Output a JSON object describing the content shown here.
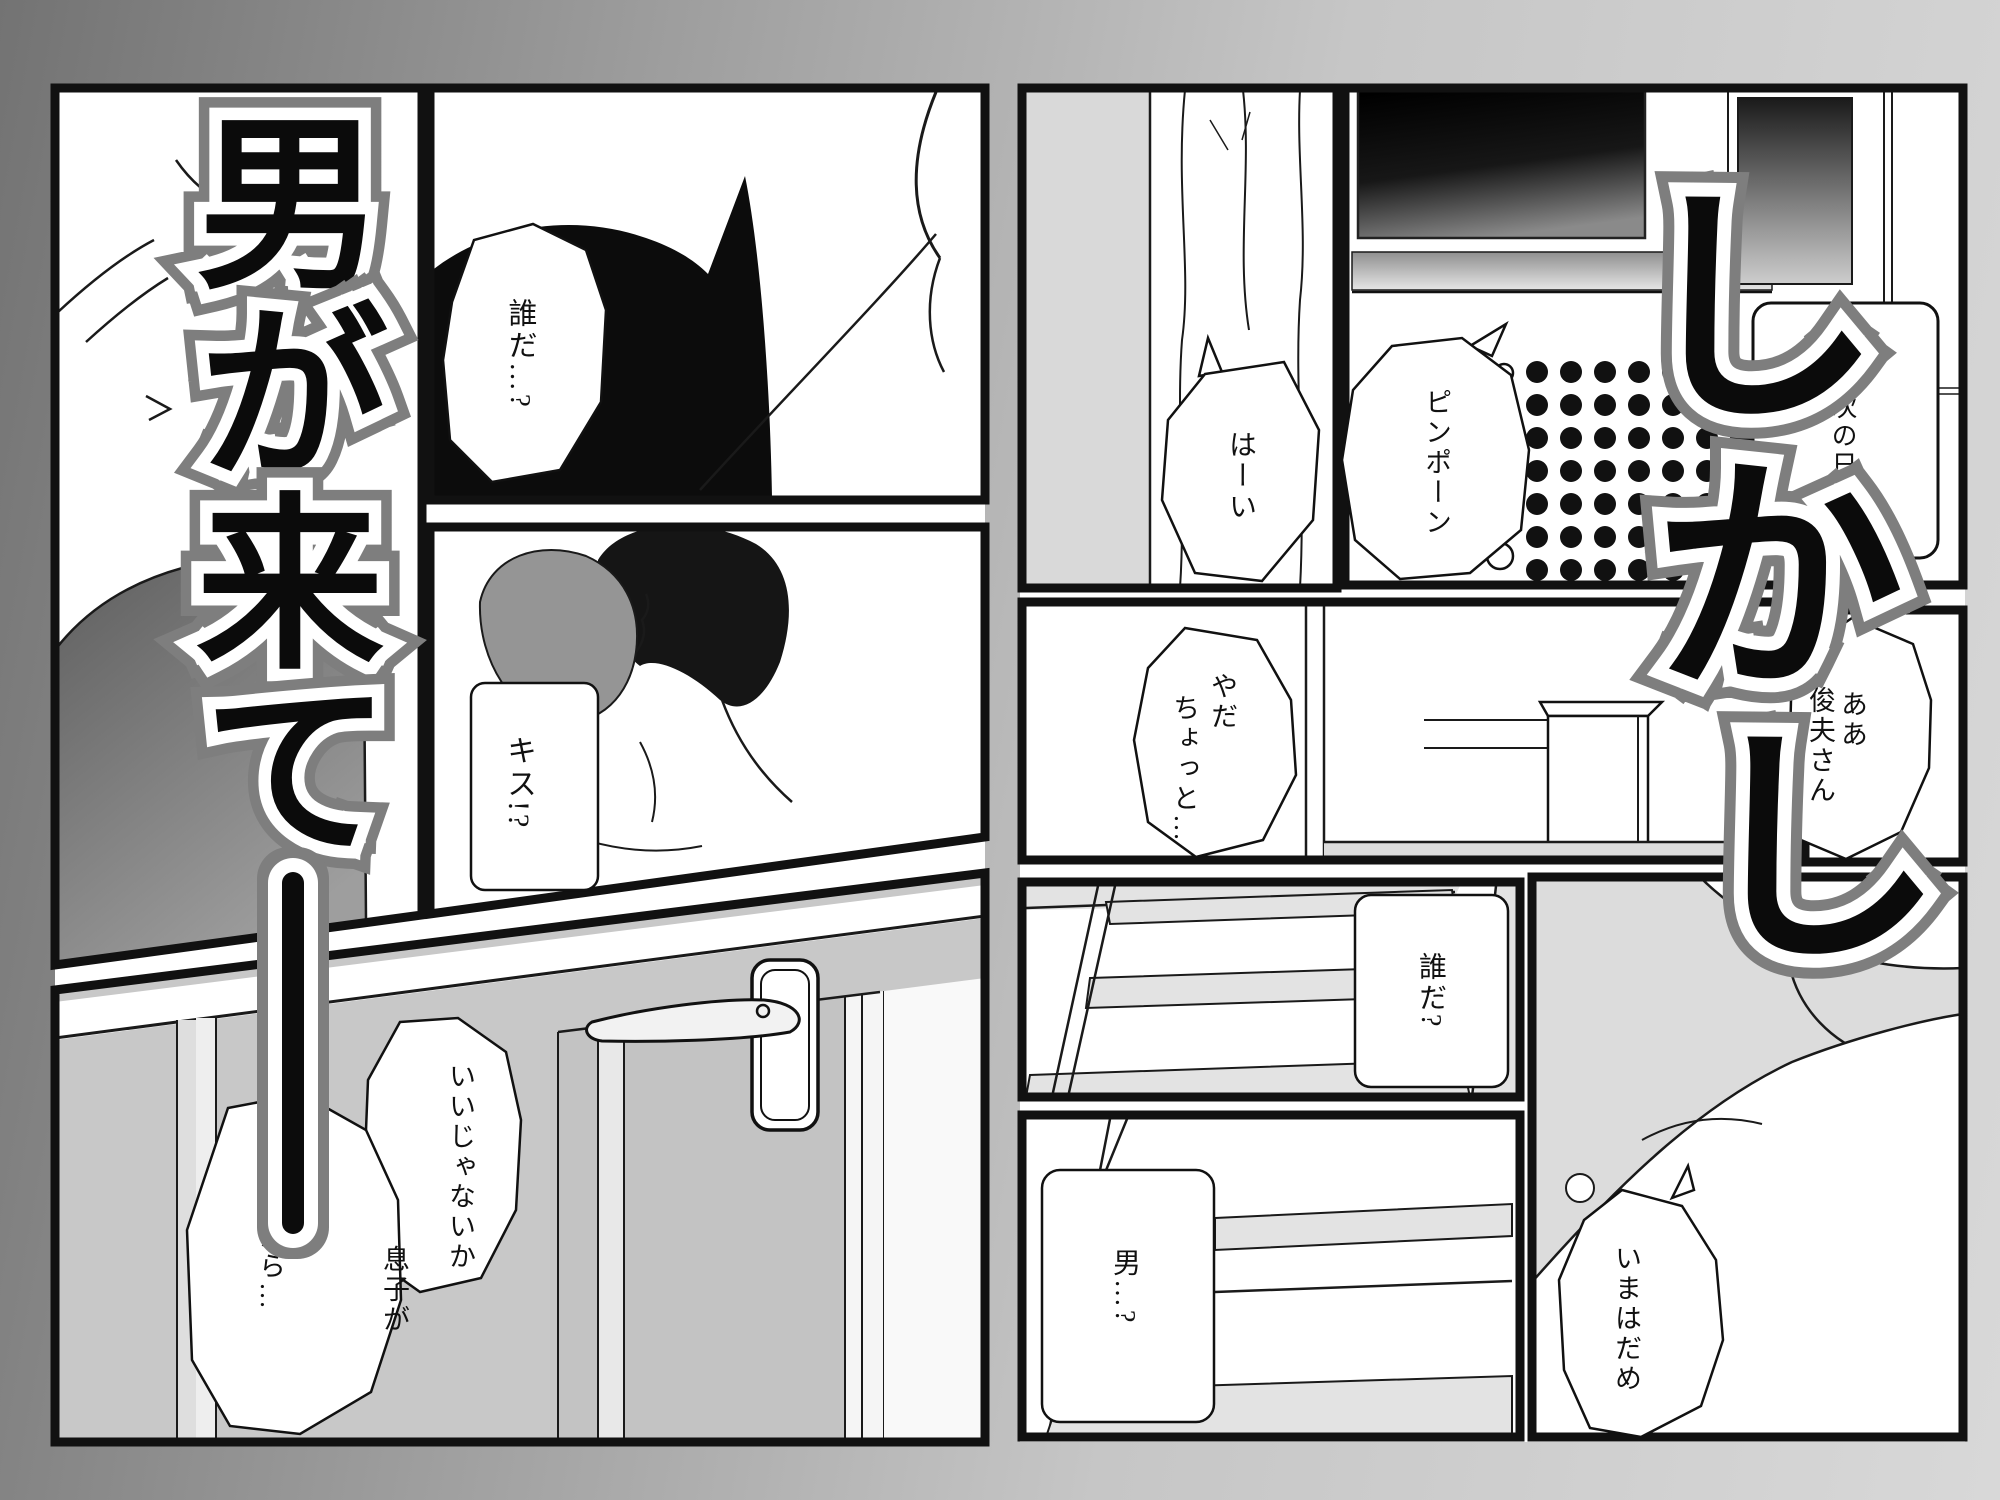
{
  "titles": {
    "left": {
      "text": "男が来て――",
      "chars": [
        "男",
        "が",
        "来",
        "て"
      ]
    },
    "right": {
      "text": "しかし",
      "chars": [
        "し",
        "か",
        "し"
      ]
    }
  },
  "left_page": {
    "panel_top_black": {
      "bubble": "誰だ…?"
    },
    "panel_kiss": {
      "caption": "キス!?"
    },
    "panel_door": {
      "bubble_approval": "いいじゃないか",
      "bubble_son_col_right": "息子が",
      "bubble_son_col_left": "いるから…"
    }
  },
  "right_page": {
    "panel_entry": {
      "bubble": "はーい"
    },
    "panel_intercom": {
      "sfx_bubble": "ピンポーン",
      "caption": "次の日"
    },
    "panel_hall": {
      "bubble_col_right": "やだ",
      "bubble_col_left": "ちょっと…"
    },
    "panel_mother": {
      "bubble_col_right": "ああ",
      "bubble_col_left": "俊夫さん"
    },
    "panel_stairs_up": {
      "caption": "誰だ?"
    },
    "panel_stairs_down": {
      "caption": "男…?"
    },
    "panel_son": {
      "bubble": "いまはだめ"
    }
  },
  "colors": {
    "panel_border": "#111111",
    "page_bg": "#ffffff",
    "backdrop_left": "#737373",
    "backdrop_right": "#d8d8d8",
    "title_fill": "#0b0b0b",
    "title_inner_outline": "#ffffff",
    "title_outer_outline": "#7e7e7e",
    "dark_silhouette": "#0c0c0c",
    "door_gray": "#c3c3c3",
    "wall_gray": "#d9d9d9",
    "stair_tread_gray": "#e3e3e3"
  }
}
